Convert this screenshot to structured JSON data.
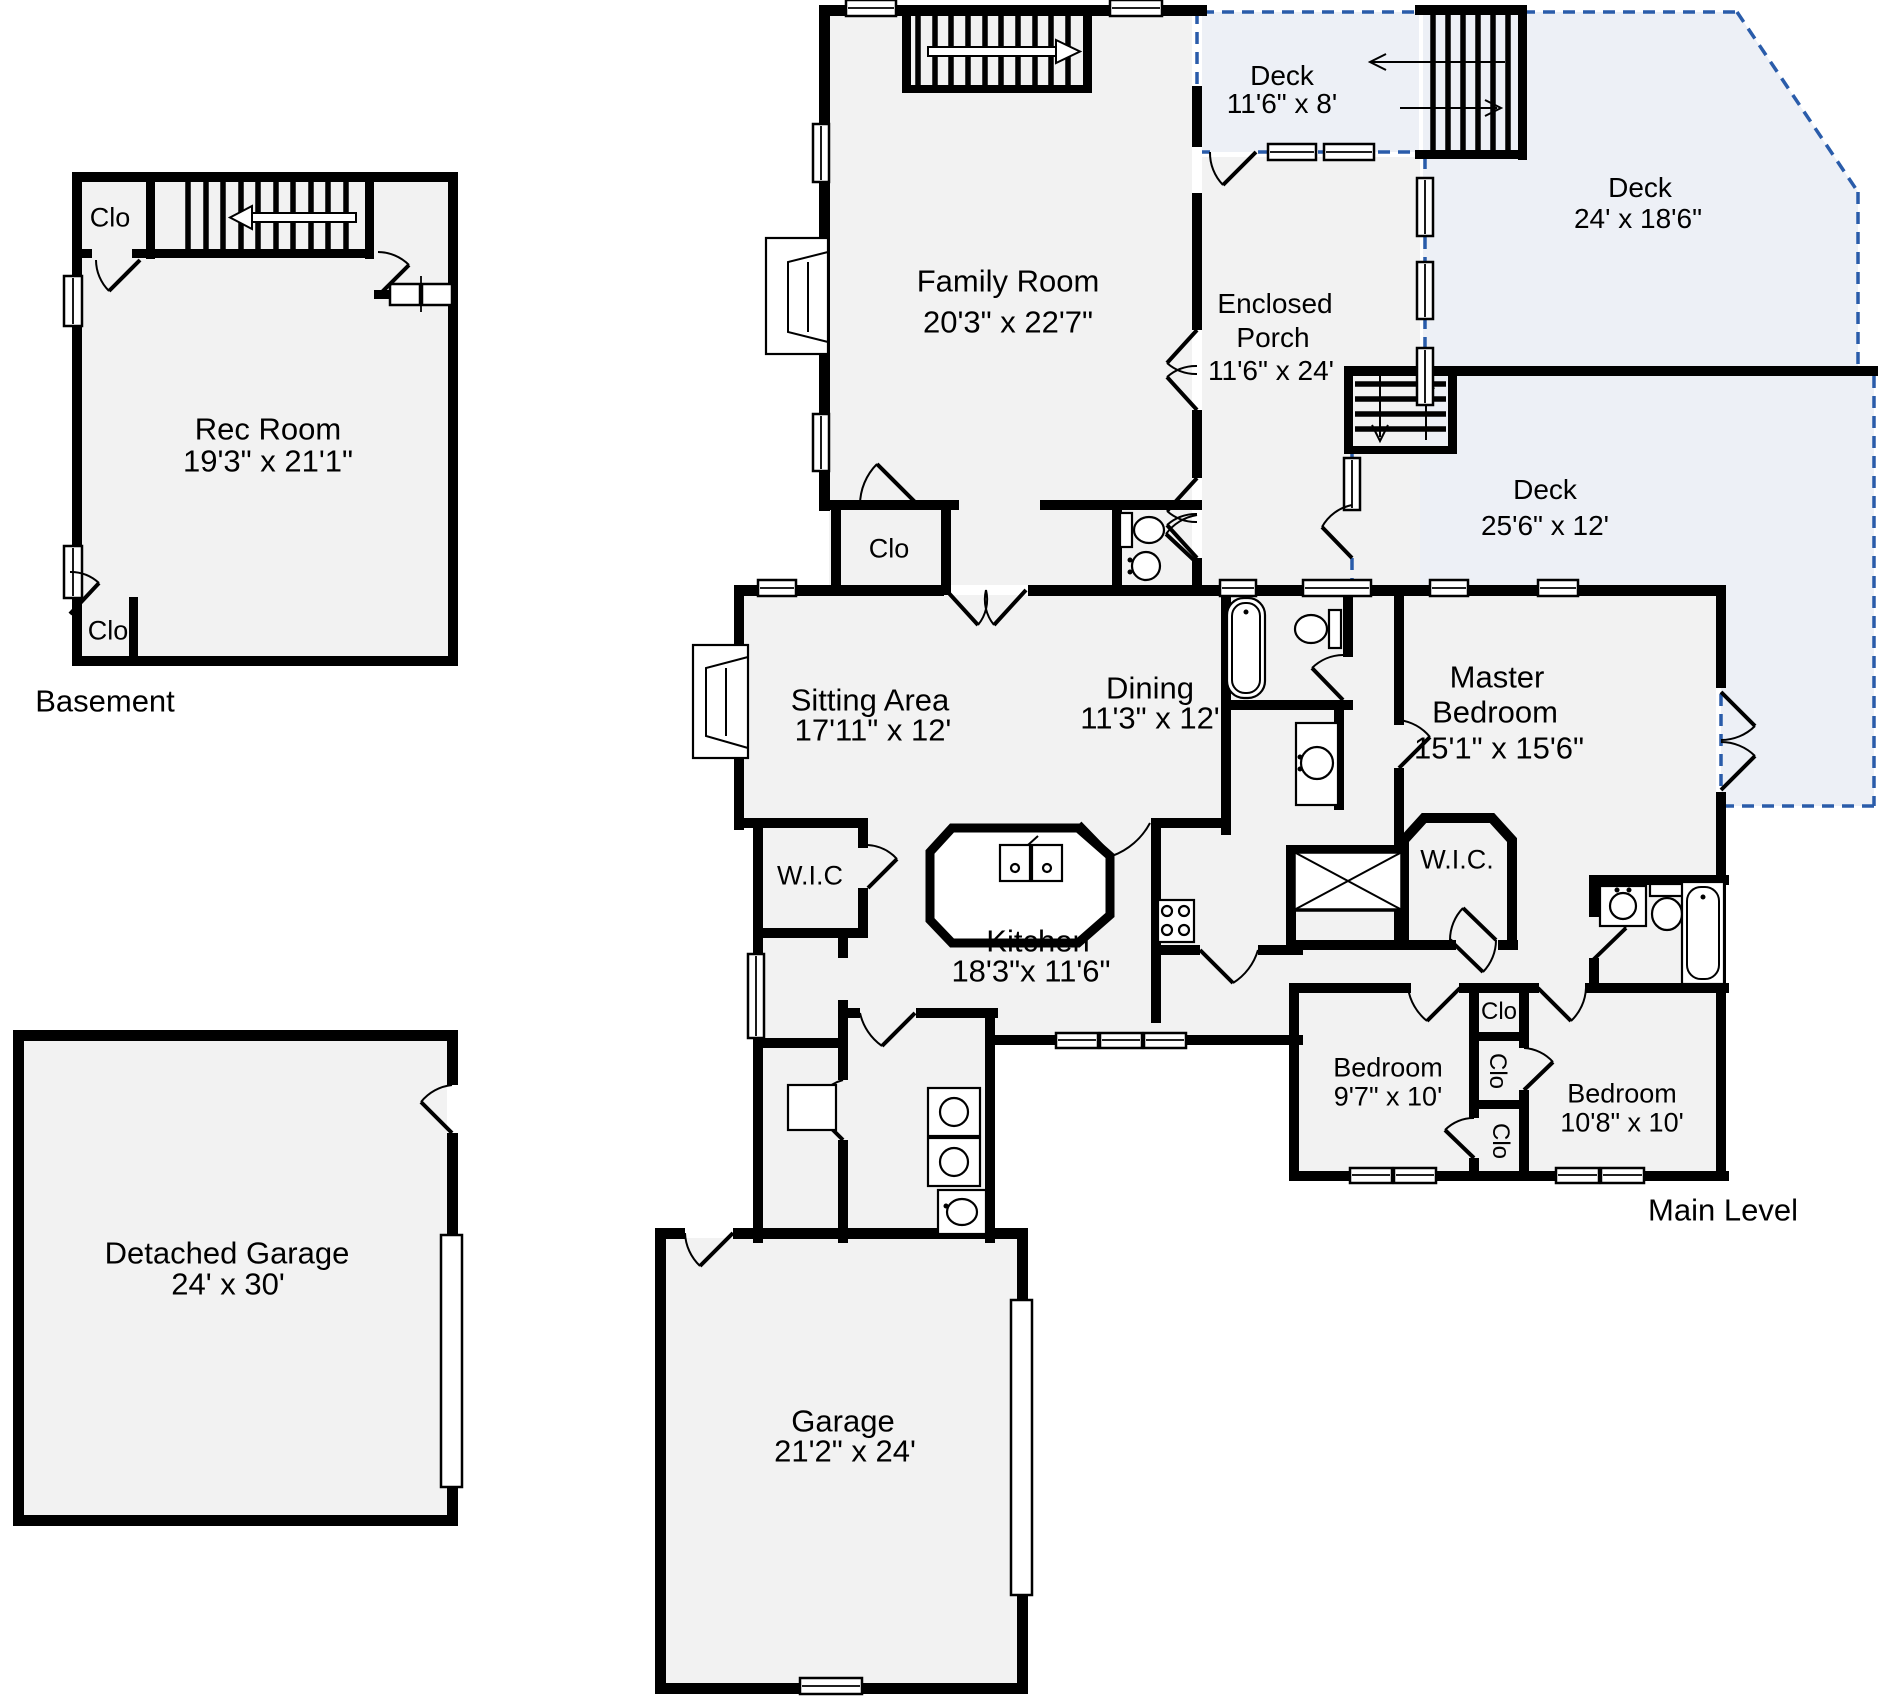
{
  "page": {
    "type": "residential-floor-plan"
  },
  "colors": {
    "wall": "#000000",
    "room_fill": "#f2f2f2",
    "deck_fill": "#edf0f6",
    "deck_outline": "#2a5caa",
    "text": "#000000",
    "background": "#ffffff"
  },
  "sections": {
    "basement": "Basement",
    "main_level": "Main Level"
  },
  "labels": {
    "clo": "Clo",
    "wic_left": "W.I.C",
    "wic_master": "W.I.C."
  },
  "rooms": {
    "rec_room": {
      "name": "Rec Room",
      "dims": "19'3\" x 21'1\""
    },
    "family_room": {
      "name": "Family Room",
      "dims": "20'3\" x 22'7\""
    },
    "deck_top": {
      "name": "Deck",
      "dims": "11'6\" x 8'"
    },
    "deck_right": {
      "name": "Deck",
      "dims": "24' x 18'6\""
    },
    "enclosed_porch": {
      "line1": "Enclosed",
      "line2": "Porch",
      "dims": "11'6\" x 24'"
    },
    "deck_lower": {
      "name": "Deck",
      "dims": "25'6\" x 12'"
    },
    "sitting_area": {
      "name": "Sitting Area",
      "dims": "17'11\" x 12'"
    },
    "dining": {
      "name": "Dining",
      "dims": "11'3\" x 12'"
    },
    "master_bedroom": {
      "line1": "Master",
      "line2": "Bedroom",
      "dims": "15'1\" x 15'6\""
    },
    "kitchen": {
      "name": "Kitchen",
      "dims": "18'3\"x  11'6\""
    },
    "bedroom_left": {
      "name": "Bedroom",
      "dims": "9'7\" x 10'"
    },
    "bedroom_right": {
      "name": "Bedroom",
      "dims": "10'8\" x 10'"
    },
    "garage": {
      "name": "Garage",
      "dims": "21'2\" x 24'"
    },
    "detached_garage": {
      "name": "Detached Garage",
      "dims": "24' x 30'"
    }
  }
}
